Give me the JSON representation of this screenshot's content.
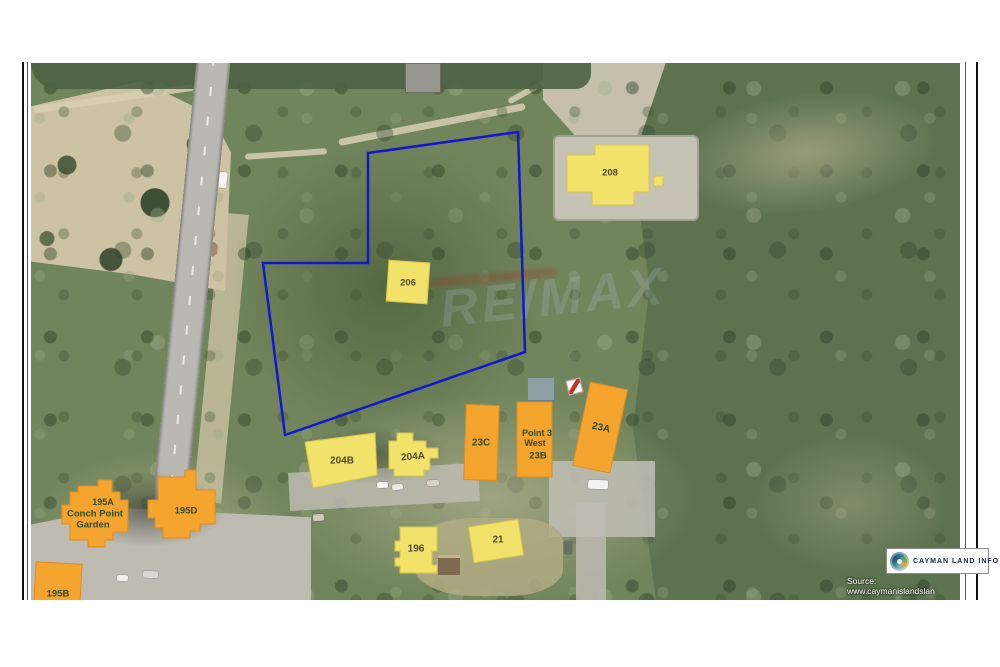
{
  "map": {
    "watermark": "RE/MAX",
    "source_text": "Source: www.caymanislandslan",
    "boundary_color": "#1515d0",
    "parcel_colors": {
      "yellow": "#f2e26a",
      "orange": "#f5a52e"
    },
    "parcels": [
      {
        "id": "208",
        "label": "208",
        "type": "yellow"
      },
      {
        "id": "206",
        "label": "206",
        "type": "yellow"
      },
      {
        "id": "204B",
        "label": "204B",
        "type": "yellow"
      },
      {
        "id": "204A",
        "label": "204A",
        "type": "yellow"
      },
      {
        "id": "23C",
        "label": "23C",
        "type": "orange"
      },
      {
        "id": "23B",
        "label_line1": "Point 3",
        "label_line2": "West",
        "label_line3": "23B",
        "type": "orange"
      },
      {
        "id": "23A",
        "label": "23A",
        "type": "orange"
      },
      {
        "id": "196",
        "label": "196",
        "type": "yellow"
      },
      {
        "id": "21",
        "label": "21",
        "type": "yellow"
      },
      {
        "id": "195A",
        "label_line1": "195A",
        "label_line2": "Conch Point",
        "label_line3": "Garden",
        "type": "orange"
      },
      {
        "id": "195D",
        "label": "195D",
        "type": "orange"
      },
      {
        "id": "195B",
        "label": "195B",
        "type": "orange"
      }
    ]
  },
  "branding": {
    "logo_text": "CAYMAN LAND INFO"
  }
}
